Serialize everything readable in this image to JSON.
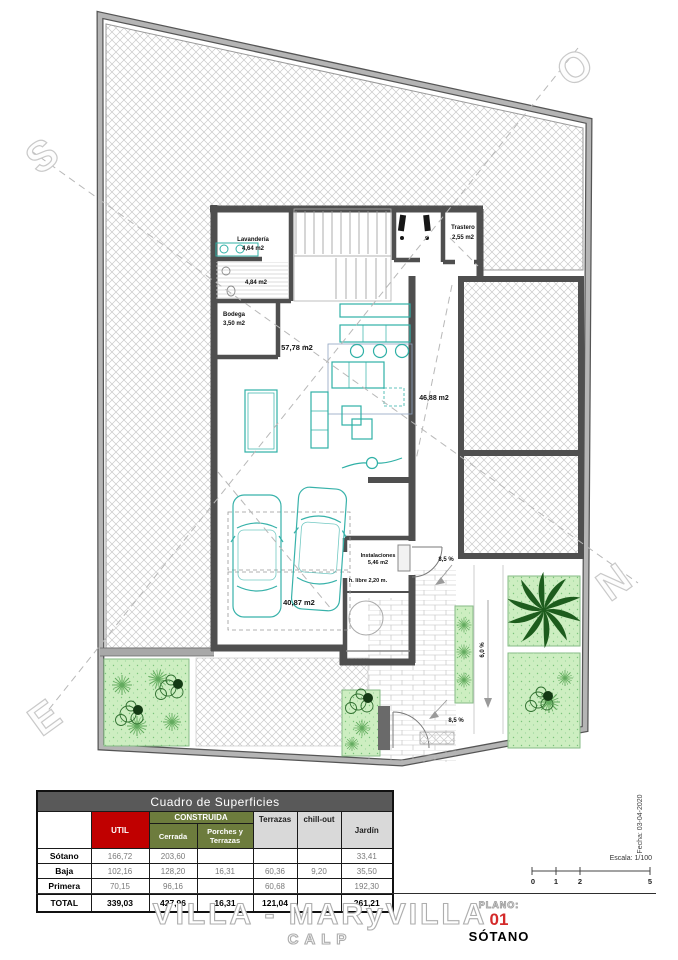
{
  "plan": {
    "compass": {
      "s": "S",
      "o": "O",
      "e": "E",
      "n": "N"
    },
    "labels": {
      "lavanderia": "Lavandería",
      "lavanderia_area": "4,64 m2",
      "bath_area": "4,84 m2",
      "bodega": "Bodega",
      "bodega_area": "3,50 m2",
      "salon_area": "57,78 m2",
      "trastero": "Trastero",
      "trastero_area": "2,55 m2",
      "patio_area": "46,88 m2",
      "garaje_area": "40,87 m2",
      "instalaciones": "Instalaciones",
      "instalaciones_area": "5,46 m2",
      "altura_libre": "h. libre 2,20 m.",
      "slope_top": "8,5 %",
      "slope_ramp": "6,0 %",
      "slope_bottom": "8,5 %"
    }
  },
  "table": {
    "title": "Cuadro de Superficies",
    "headers": {
      "util": "UTIL",
      "construida": "CONSTRUIDA",
      "cerrada": "Cerrada",
      "porches": "Porches y Terrazas",
      "terrazas": "Terrazas",
      "chillout": "chill-out",
      "jardin": "Jardín"
    },
    "rows": [
      {
        "label": "Sótano",
        "util": "166,72",
        "cerrada": "203,60",
        "porches": "",
        "terrazas": "",
        "chillout": "",
        "jardin": "33,41"
      },
      {
        "label": "Baja",
        "util": "102,16",
        "cerrada": "128,20",
        "porches": "16,31",
        "terrazas": "60,36",
        "chillout": "9,20",
        "jardin": "35,50"
      },
      {
        "label": "Primera",
        "util": "70,15",
        "cerrada": "96,16",
        "porches": "",
        "terrazas": "60,68",
        "chillout": "",
        "jardin": "192,30"
      },
      {
        "label": "TOTAL",
        "util": "339,03",
        "cerrada": "427,96",
        "porches": "16,31",
        "terrazas": "121,04",
        "chillout": "",
        "jardin": "261,21"
      }
    ]
  },
  "meta": {
    "fecha": "Fecha: 03-04-2020",
    "escala": "Escala: 1/100",
    "ticks": [
      "0",
      "1",
      "2",
      "5"
    ]
  },
  "footer": {
    "project": "VILLA - MARyVILLA",
    "location": "CALP",
    "plano_label": "PLANO:",
    "plano_number": "01",
    "plano_name": "SÓTANO"
  },
  "colors": {
    "accent_red": "#c00000",
    "table_header_gray": "#595959",
    "construida_green": "#6d7c3d",
    "light_gray_header": "#d9d9d9",
    "furniture_teal": "#2fb0a6",
    "garden_green": "#cdeec1",
    "palm_green": "#1d5c1d",
    "wall_gray": "#4f4f4f"
  }
}
